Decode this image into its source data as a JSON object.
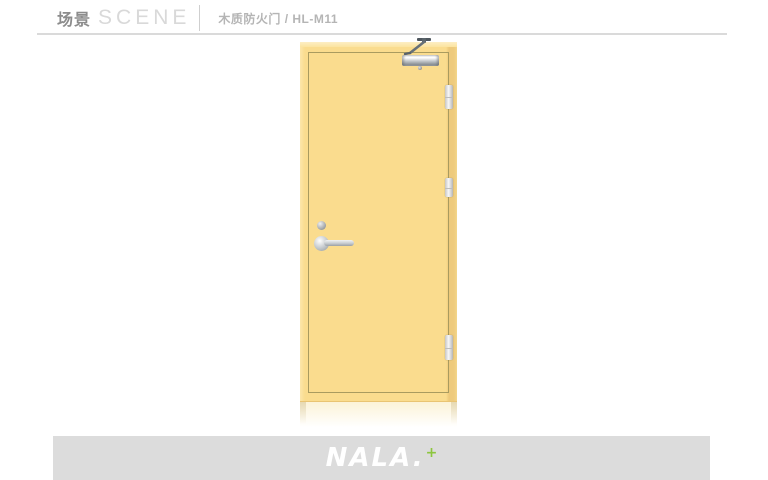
{
  "header": {
    "title_cn": "场景",
    "title_en": "SCENE",
    "subtitle": "木质防火门 / HL-M11"
  },
  "product": {
    "category": "木质防火门",
    "model": "HL-M11",
    "hardware_icons": [
      "door-closer-icon",
      "hinge-icon",
      "hinge-icon",
      "hinge-icon",
      "lock-cylinder-icon",
      "lever-handle-icon"
    ],
    "colors": {
      "door_face": "#fadc8e",
      "door_bevel": "#fdeec4",
      "door_edge_shadow": "#edc97b",
      "panel_outline": "#a99b5f",
      "hardware_silver": "#c7ccd0"
    }
  },
  "footer": {
    "brand": "NALA.",
    "brand_plus": "+",
    "colors": {
      "bar": "#dcdcdc",
      "brand_text": "#ffffff",
      "plus": "#8cc63e"
    }
  }
}
